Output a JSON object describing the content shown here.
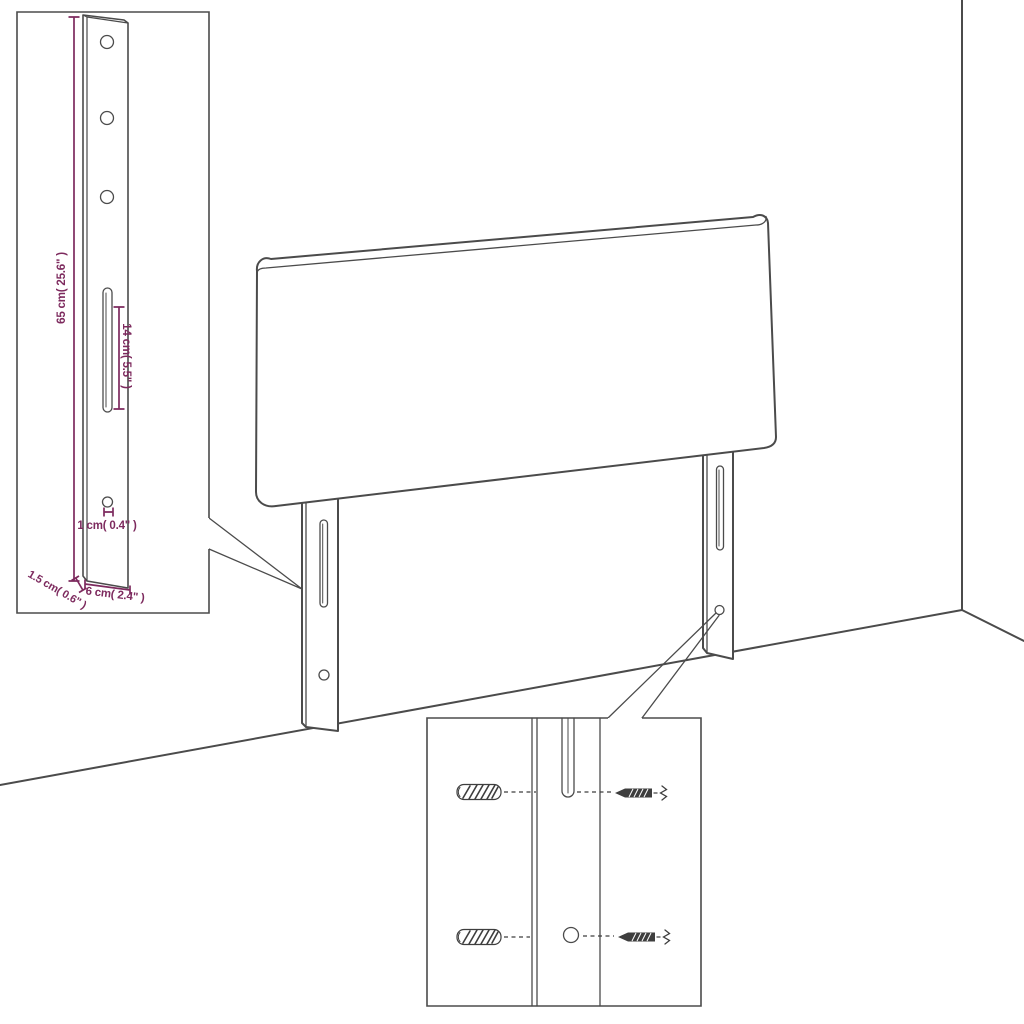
{
  "colors": {
    "line": "#4b4b4b",
    "annotation": "#7d2a5e",
    "detail": "#3e3e3e",
    "background": "#ffffff"
  },
  "bracket_inset": {
    "dim_height": "65 cm( 25.6\" )",
    "dim_slot": "14 cm( 5.5\" )",
    "dim_hole": "1 cm( 0.4\" )",
    "dim_thickness": "1.5 cm( 0.6\" )",
    "dim_width": "6 cm( 2.4\" )",
    "hole_count": 4,
    "slot_count": 1
  },
  "mounting_inset": {
    "wall_plug_icon": "wall-plug-icon",
    "screw_icon": "screw-icon",
    "wall_plug_count": 2,
    "screw_count": 2
  },
  "scene": {
    "leg_count": 2
  }
}
